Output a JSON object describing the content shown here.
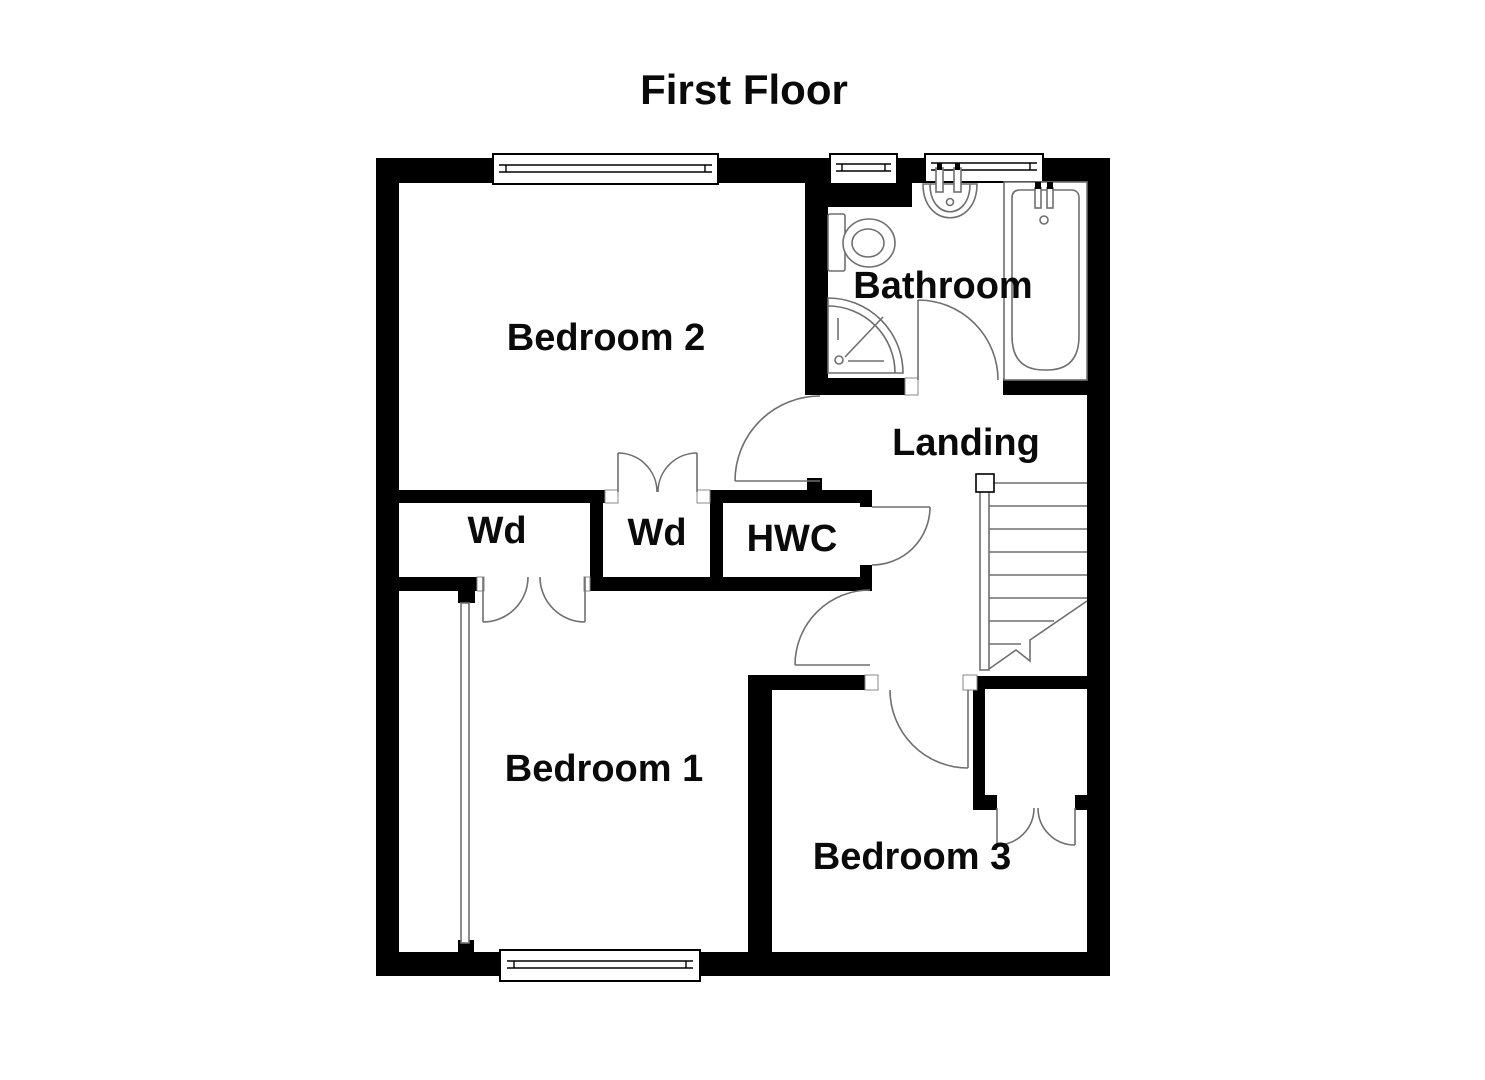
{
  "title": "First Floor",
  "rooms": {
    "bedroom2": "Bedroom 2",
    "bathroom": "Bathroom",
    "landing": "Landing",
    "wardrobe1": "Wd",
    "wardrobe2": "Wd",
    "hwc": "HWC",
    "bedroom1": "Bedroom 1",
    "bedroom3": "Bedroom 3"
  },
  "colors": {
    "wall": "#000000",
    "fixture_line": "#6f6f6f",
    "background": "#ffffff",
    "text": "#0a0a0a"
  }
}
